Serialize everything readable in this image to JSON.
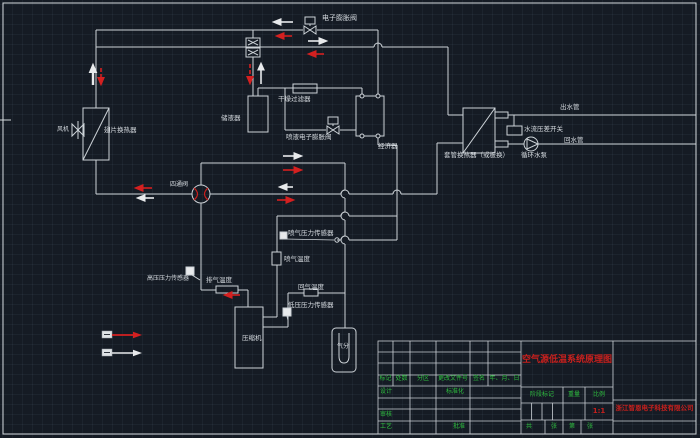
{
  "colors": {
    "background": "#151b24",
    "line": "#d4d9dd",
    "arrow_red": "#d42020",
    "text_green": "#2fbf3f",
    "text_red": "#c8201d"
  },
  "schematic": {
    "labels": {
      "eev": "电子膨胀阀",
      "fan": "风机",
      "fin_hx": "翅片换热器",
      "receiver": "储液器",
      "drier": "干燥过滤器",
      "liquid_eev": "喷液电子膨胀阀",
      "economizer": "经济器",
      "coax_hx": "套管换热器（或板换）",
      "water_out": "出水管",
      "flow_switch": "水流压差开关",
      "water_return": "回水管",
      "pump": "循环水泵",
      "four_way_valve": "四通阀",
      "inj_pressure_sensor": "喷气压力传感器",
      "inj_temp": "喷气温度",
      "return_temp": "回气温度",
      "low_pressure_sensor": "低压压力传感器",
      "compressor": "压缩机",
      "discharge_temp": "排气温度",
      "high_pressure_sensor": "高压压力传感器",
      "separator": "气分"
    }
  },
  "title_block": {
    "title": "空气源低温系统原理图",
    "company": "浙江智恩电子科技有限公司",
    "rev_headers": [
      "标记",
      "处数",
      "分区",
      "更改文件号",
      "签名",
      "年、月、日"
    ],
    "design": "设计",
    "standardize": "标准化",
    "review": "审核",
    "process": "工艺",
    "approve": "批准",
    "stage_mark": "阶段标记",
    "weight": "重量",
    "scale_label": "比例",
    "scale_value": "1:1",
    "sheet_total": "共",
    "sheet_unit1": "张",
    "sheet_no": "第",
    "sheet_unit2": "张"
  }
}
